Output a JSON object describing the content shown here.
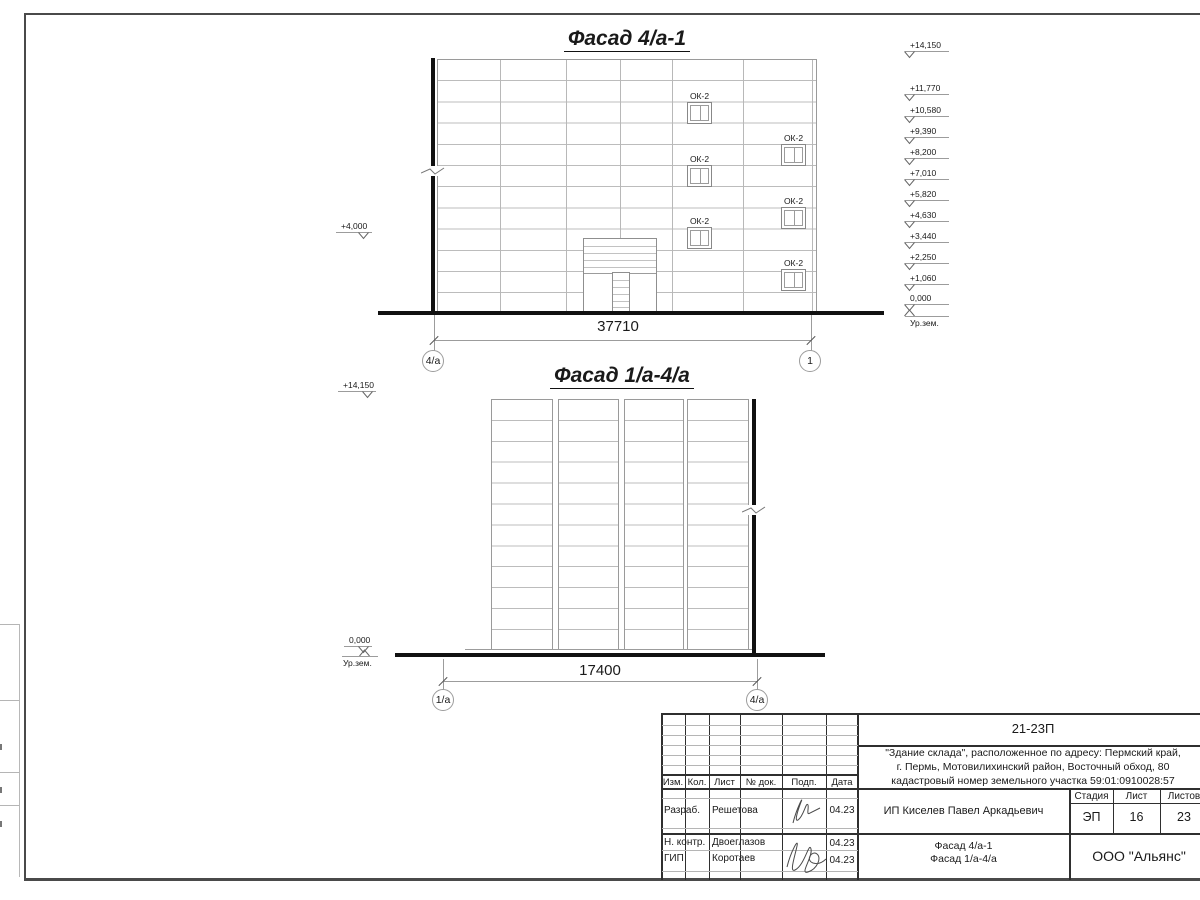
{
  "facade1": {
    "title": "Фасад 4/а-1",
    "window_label": "ОК-2",
    "left_elevation": "+4,000",
    "elevations": [
      "+14,150",
      "+11,770",
      "+10,580",
      "+9,390",
      "+8,200",
      "+7,010",
      "+5,820",
      "+4,630",
      "+3,440",
      "+2,250",
      "+1,060",
      "0,000"
    ],
    "ground_label": "Ур.зем.",
    "dimension": "37710",
    "axis_left": "4/а",
    "axis_right": "1"
  },
  "facade2": {
    "title": "Фасад 1/а-4/а",
    "elevation_top": "+14,150",
    "elevation_zero": "0,000",
    "ground_label": "Ур.зем.",
    "dimension": "17400",
    "axis_left": "1/а",
    "axis_right": "4/а"
  },
  "titleblock": {
    "doc_number": "21-23П",
    "project_lines": [
      "\"Здание склада\", расположенное по адресу: Пермский край,",
      "г. Пермь, Мотовилихинский район, Восточный обход, 80",
      "кадастровый номер земельного участка 59:01:0910028:57"
    ],
    "columns": {
      "izm": "Изм.",
      "kol": "Кол.",
      "list": "Лист",
      "doc": "№ док.",
      "podp": "Подп.",
      "data": "Дата"
    },
    "rows": [
      {
        "role": "Разраб.",
        "name": "Решетова",
        "date": "04.23"
      },
      {
        "role": "Н. контр.",
        "name": "Двоеглазов",
        "date": "04.23"
      },
      {
        "role": "ГИП",
        "name": "Коротаев",
        "date": "04.23"
      }
    ],
    "client": "ИП Киселев Павел Аркадьевич",
    "stage_label": "Стадия",
    "sheet_label": "Лист",
    "sheets_label": "Листов",
    "stage": "ЭП",
    "sheet_number": "16",
    "sheets_total": "23",
    "drawing_titles": [
      "Фасад 4/а-1",
      "Фасад 1/а-4/а"
    ],
    "company": "ООО \"Альянс\""
  }
}
